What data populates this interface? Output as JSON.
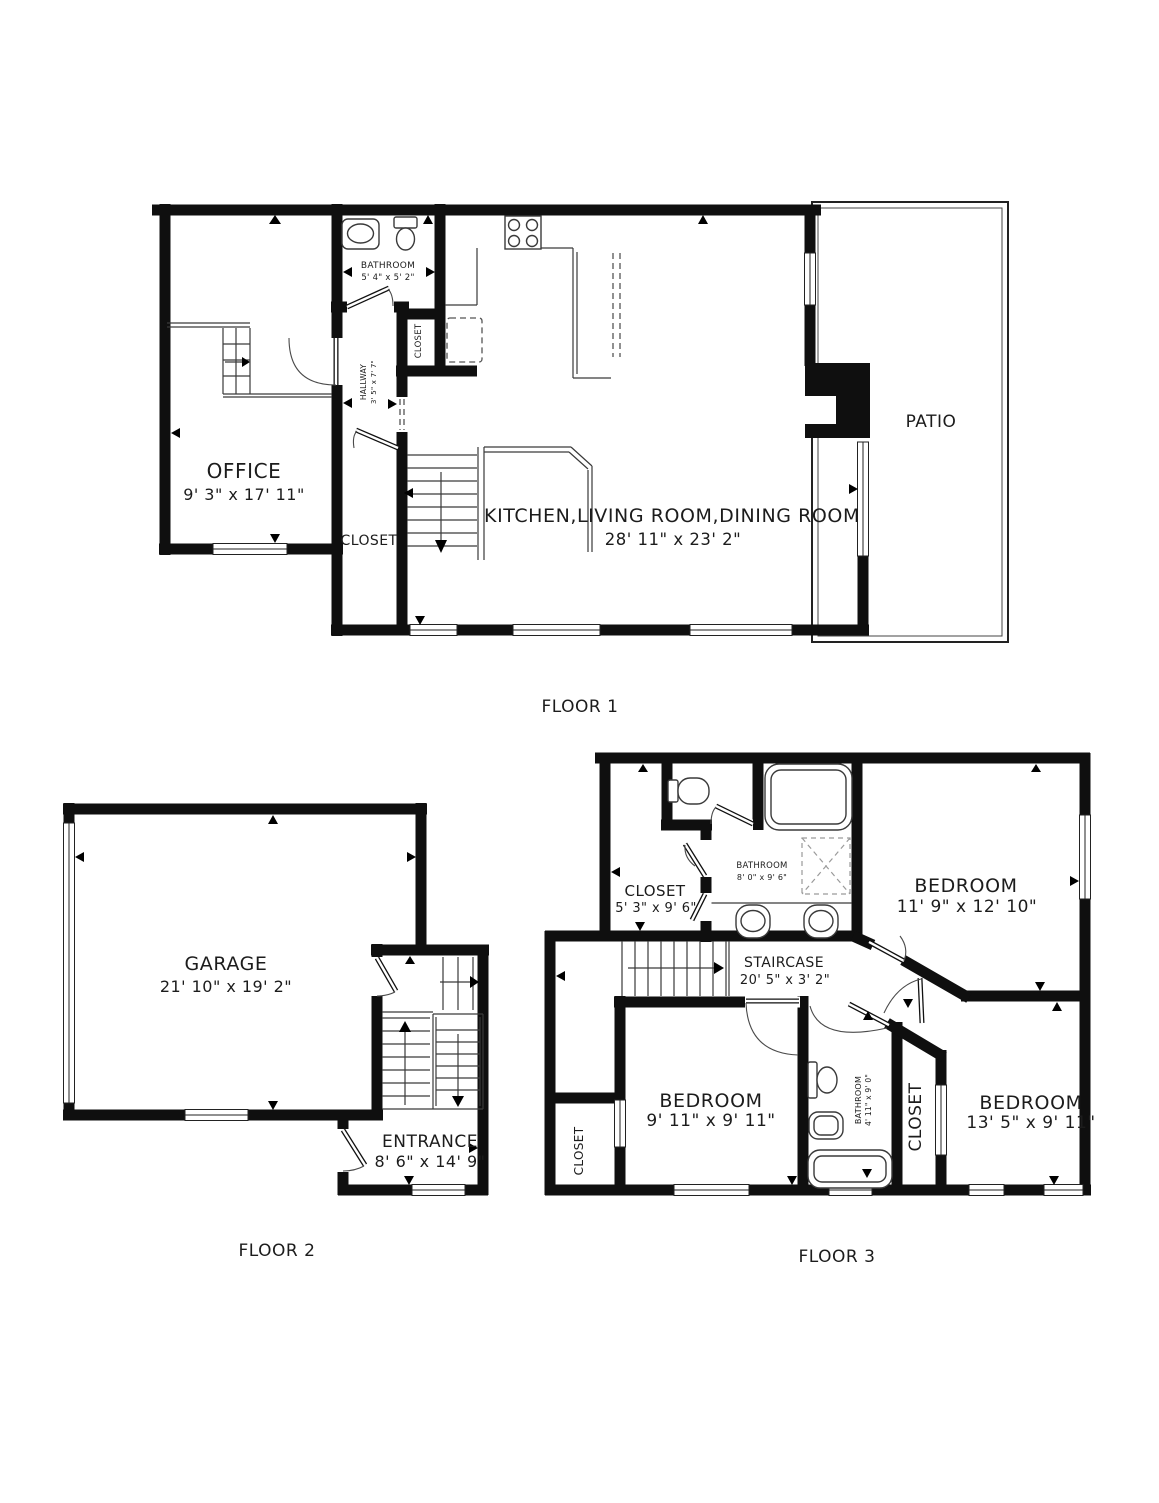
{
  "colors": {
    "background": "#ffffff",
    "walls": "#0f0f0f",
    "text": "#1c1c1c"
  },
  "floors": [
    {
      "label": "FLOOR 1",
      "rooms": {
        "office": {
          "name": "OFFICE",
          "dims": "9' 3\" x 17' 11\""
        },
        "bathroom": {
          "name": "BATHROOM",
          "dims": "5' 4\" x 5' 2\""
        },
        "hallway": {
          "name": "HALLWAY",
          "dims": "3' 5\" x 7' 7\""
        },
        "closet_small": {
          "name": "CLOSET"
        },
        "closet": {
          "name": "CLOSET"
        },
        "main": {
          "name": "KITCHEN,LIVING ROOM,DINING ROOM",
          "dims": "28' 11\" x 23' 2\""
        },
        "patio": {
          "name": "PATIO"
        }
      }
    },
    {
      "label": "FLOOR 2",
      "rooms": {
        "garage": {
          "name": "GARAGE",
          "dims": "21' 10\" x 19' 2\""
        },
        "entrance": {
          "name": "ENTRANCE",
          "dims": "8' 6\" x 14' 9\""
        }
      }
    },
    {
      "label": "FLOOR 3",
      "rooms": {
        "closet_top": {
          "name": "CLOSET",
          "dims": "5' 3\" x 9' 6\""
        },
        "bathroom_top": {
          "name": "BATHROOM",
          "dims": "8' 0\" x 9' 6\""
        },
        "bedroom_master": {
          "name": "BEDROOM",
          "dims": "11' 9\" x 12' 10\""
        },
        "staircase": {
          "name": "STAIRCASE",
          "dims": "20' 5\" x 3' 2\""
        },
        "bedroom_mid": {
          "name": "BEDROOM",
          "dims": "9' 11\" x 9' 11\""
        },
        "bathroom_mid": {
          "name": "BATHROOM",
          "dims": "4' 11\" x 9' 0\""
        },
        "closet_mid": {
          "name": "CLOSET"
        },
        "bedroom_right": {
          "name": "BEDROOM",
          "dims": "13' 5\" x 9' 11\""
        },
        "closet_left": {
          "name": "CLOSET"
        }
      }
    }
  ]
}
